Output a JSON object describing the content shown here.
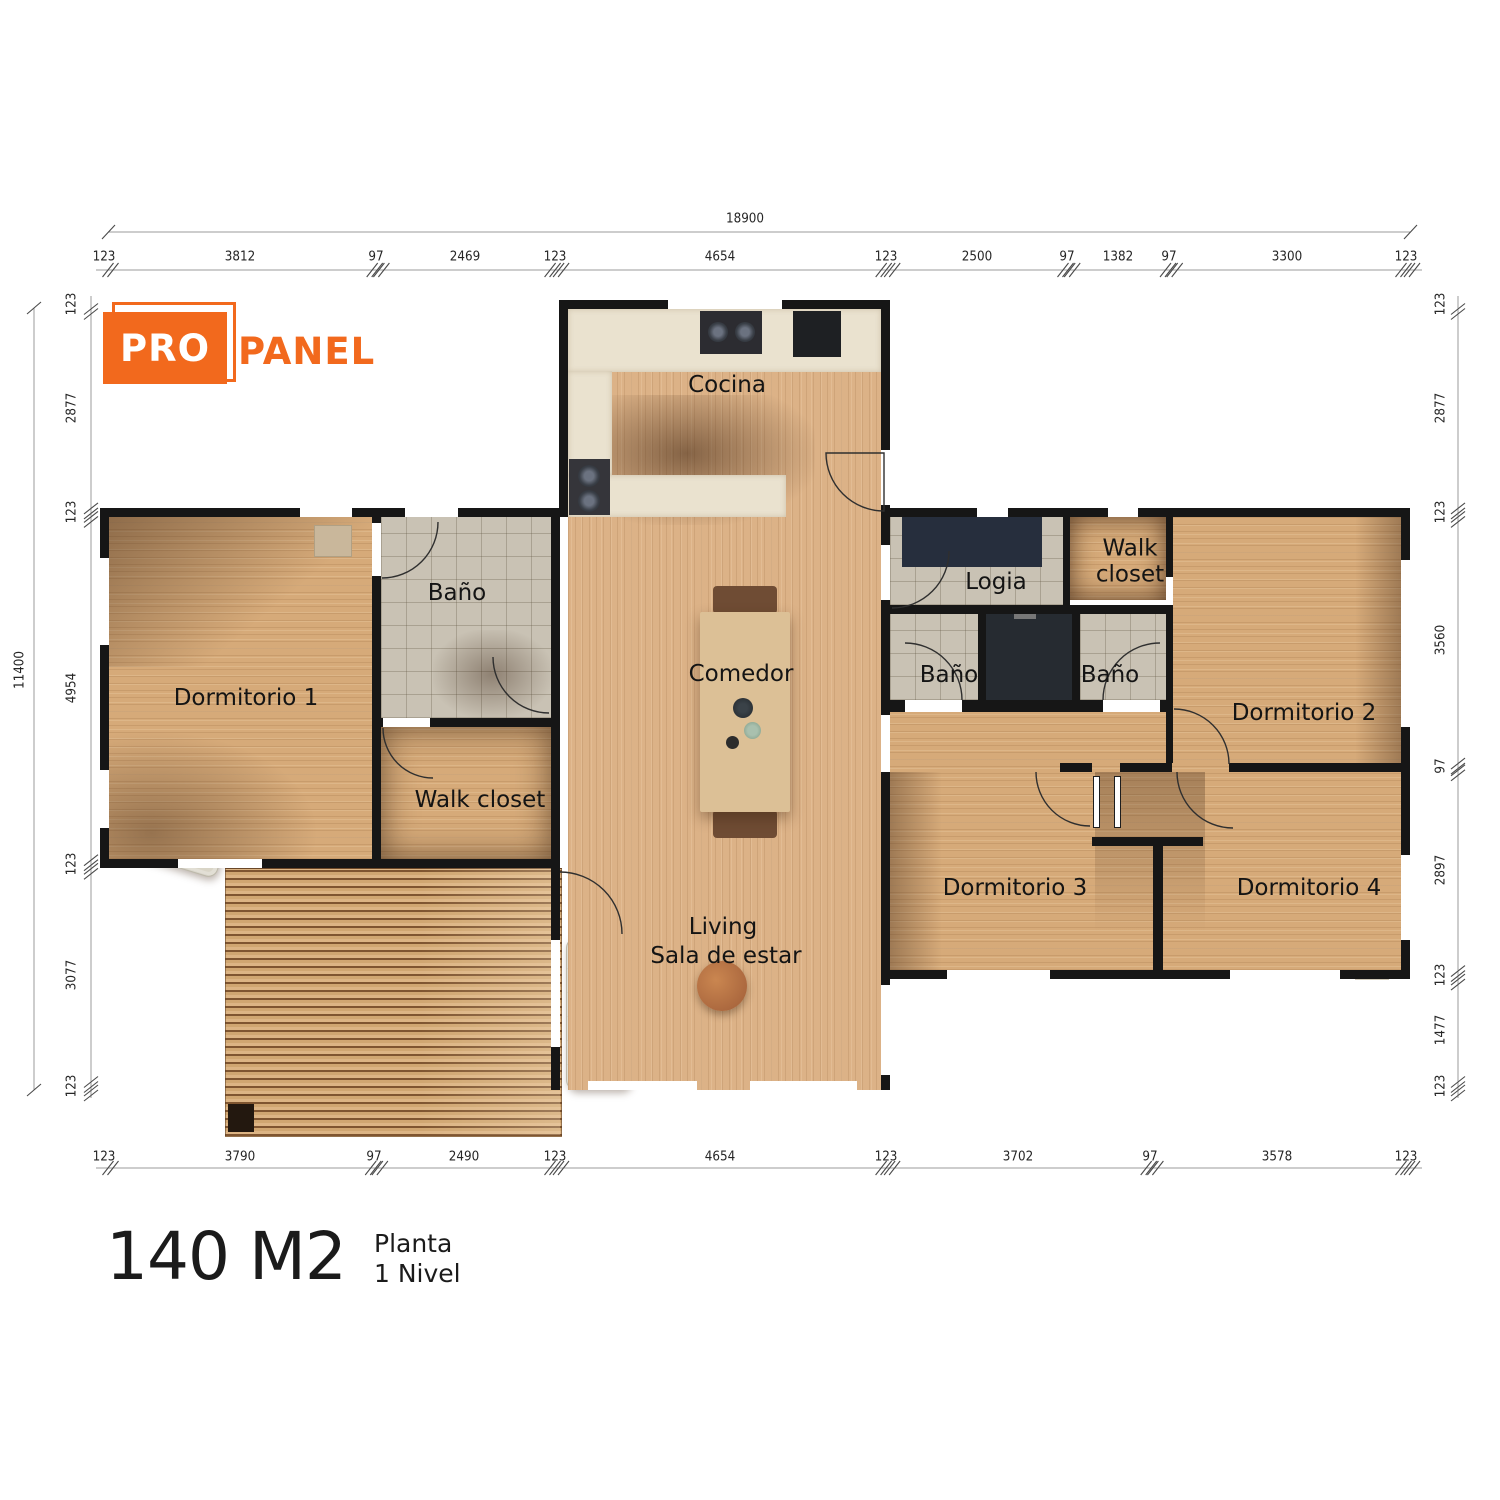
{
  "logo": {
    "pro": "PRO",
    "panel": "PANEL"
  },
  "title": {
    "area": "140 M2",
    "plan_line1": "Planta",
    "plan_line2": "1 Nivel"
  },
  "rooms": {
    "cocina": "Cocina",
    "bano_principal": "Baño",
    "dormitorio_1": "Dormitorio 1",
    "walk_closet_1": "Walk closet",
    "comedor": "Comedor",
    "logia": "Logia",
    "walk_closet_2": "Walk closet",
    "bano_2": "Baño",
    "bano_3": "Baño",
    "dormitorio_2": "Dormitorio 2",
    "dormitorio_3": "Dormitorio 3",
    "dormitorio_4": "Dormitorio 4",
    "living_1": "Living",
    "living_2": "Sala de estar"
  },
  "dimensions": {
    "total_width": "18900",
    "total_height": "11400",
    "top": [
      "123",
      "3812",
      "97",
      "2469",
      "123",
      "4654",
      "123",
      "2500",
      "97",
      "1382",
      "97",
      "3300",
      "123"
    ],
    "bottom": [
      "123",
      "3790",
      "97",
      "2490",
      "123",
      "4654",
      "123",
      "3702",
      "97",
      "3578",
      "123"
    ],
    "left": [
      "123",
      "2877",
      "123",
      "4954",
      "123",
      "3077",
      "123"
    ],
    "right": [
      "123",
      "2877",
      "123",
      "3560",
      "97",
      "2897",
      "123",
      "1477",
      "123"
    ]
  },
  "colors": {
    "accent": "#F2691D",
    "wall": "#161616"
  }
}
